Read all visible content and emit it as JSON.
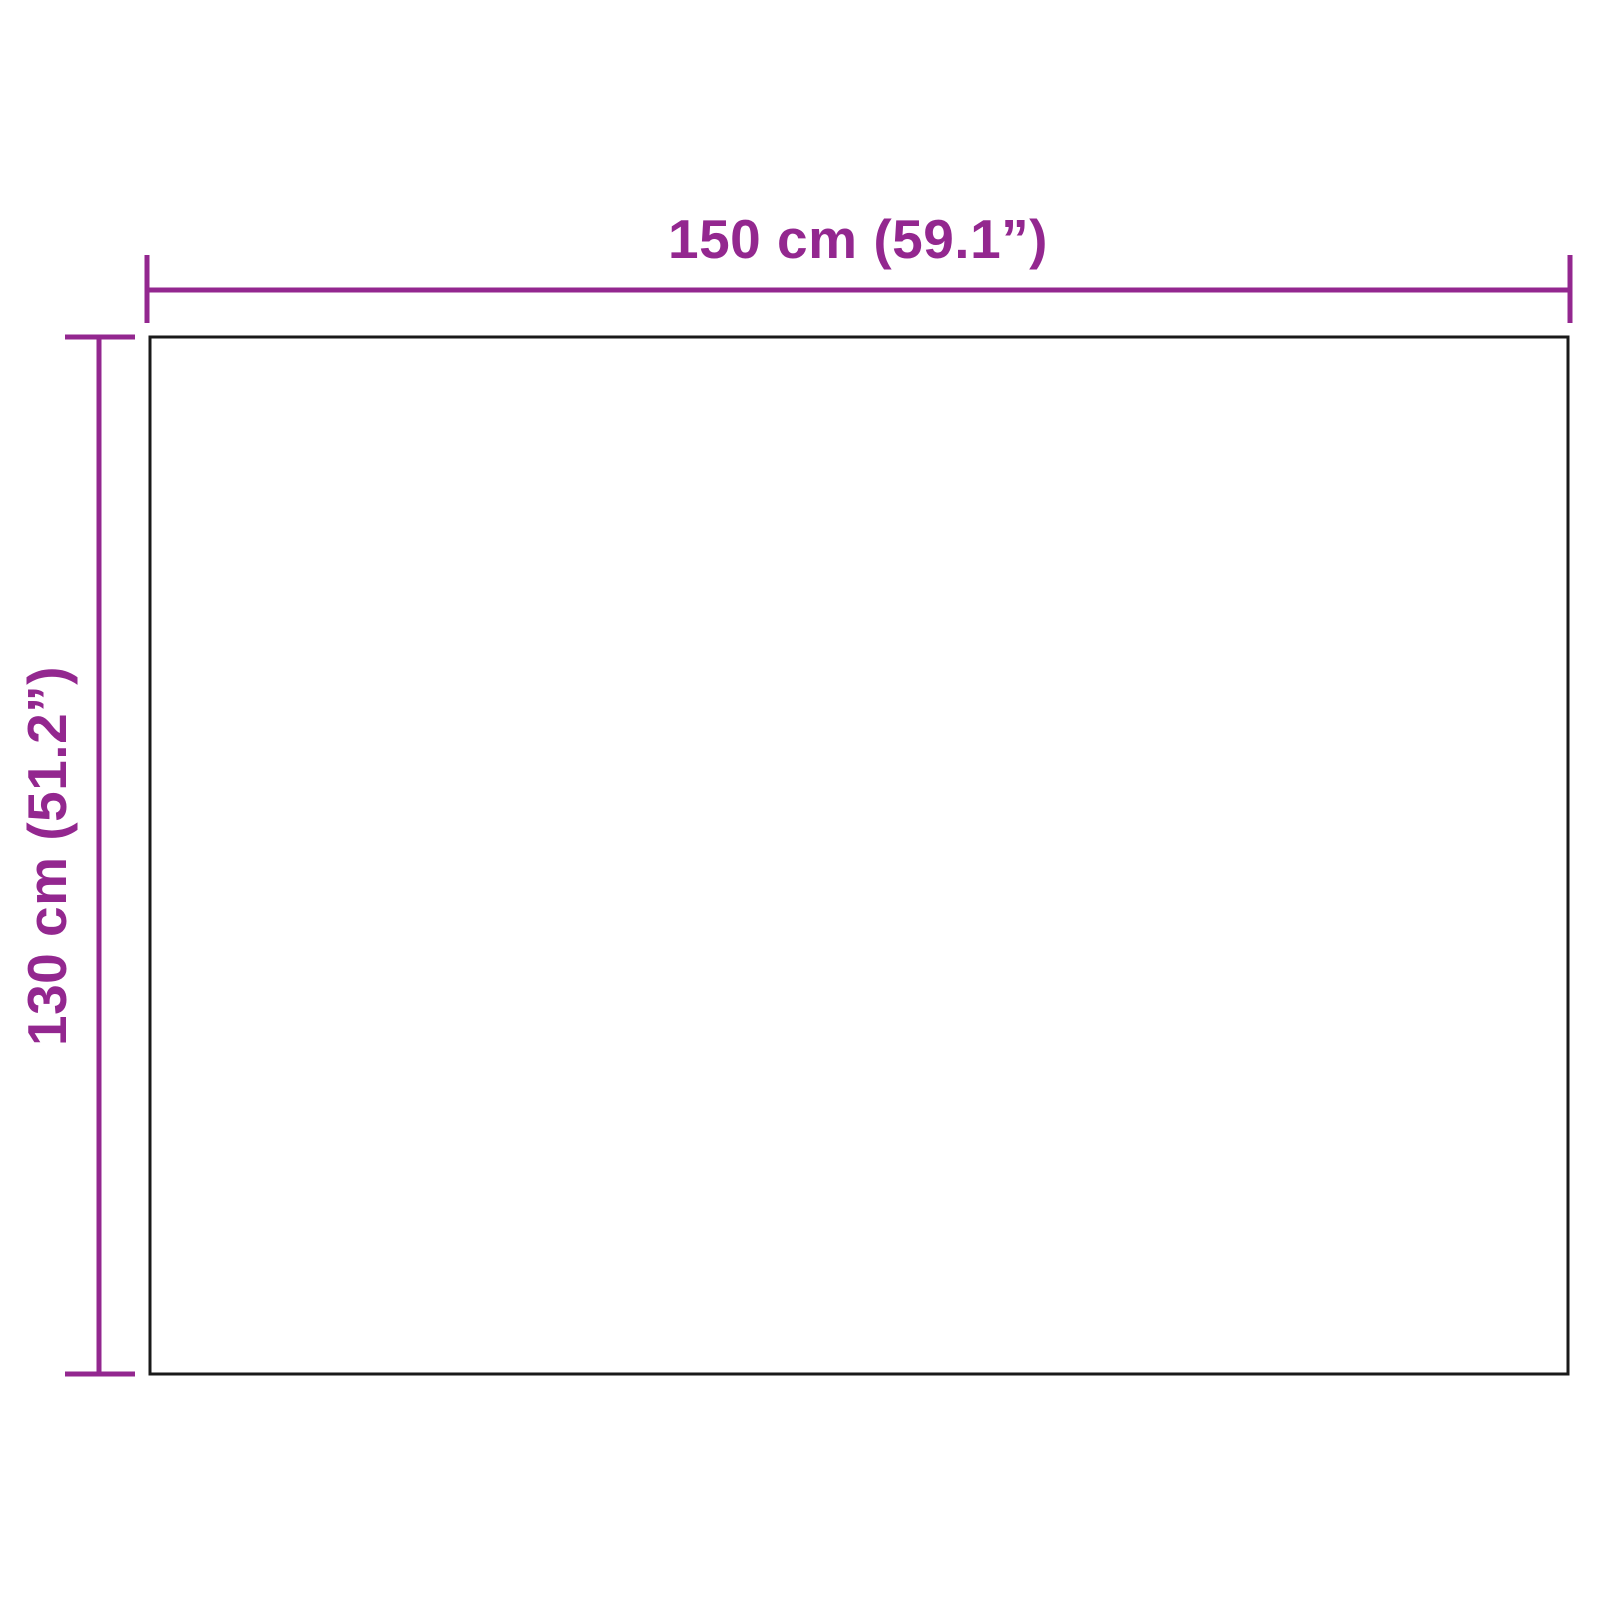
{
  "diagram": {
    "type": "product-dimension-diagram",
    "width_label": "150 cm (59.1”)",
    "height_label": "130 cm (51.2”)",
    "width_value_cm": 150,
    "width_value_in": 59.1,
    "height_value_cm": 130,
    "height_value_in": 51.2,
    "colors": {
      "accent": "#93278F",
      "outline": "#1A1A1A",
      "background": "#FFFFFF"
    }
  }
}
